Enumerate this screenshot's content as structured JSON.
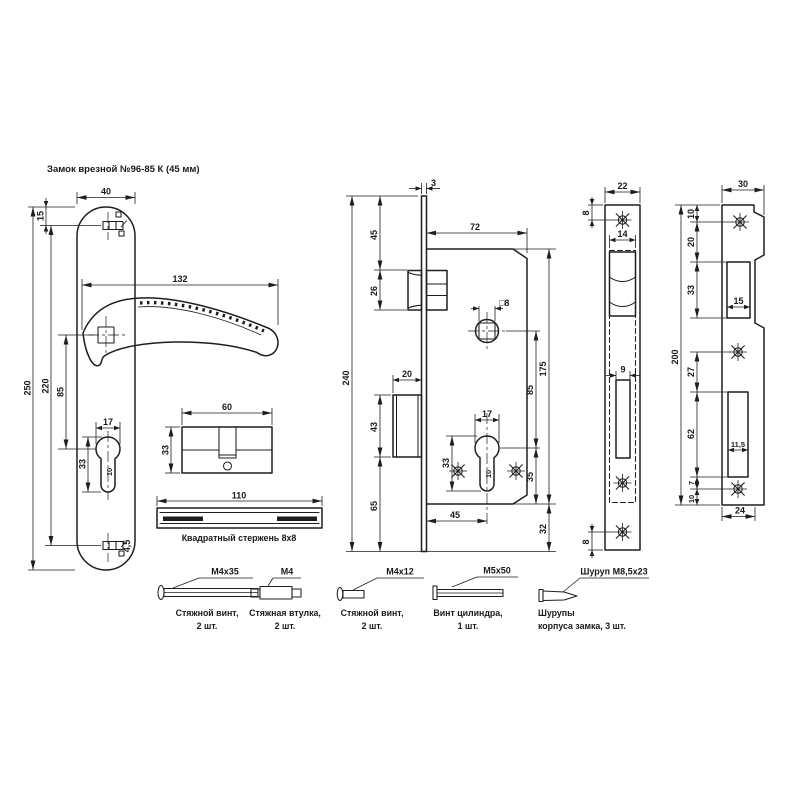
{
  "title": "Замок врезной №96-85 К (45 мм)",
  "colors": {
    "ink": "#1e1e1e",
    "background": "#ffffff"
  },
  "views": {
    "handle_plate": {
      "plate_width": "40",
      "top_edge_to_slot": "15",
      "plate_height": "250",
      "slot_span": "220",
      "handle_to_keyhole": "85",
      "handle_length": "132",
      "keyhole_width": "17",
      "keyhole_height": "33",
      "keyhole_slot_width": "10",
      "slot_hole": "4,5"
    },
    "cylinder": {
      "length": "60",
      "height": "33"
    },
    "square_rod": {
      "length": "110",
      "caption": "Квадратный стержень 8х8"
    },
    "lock_body": {
      "faceplate_thickness": "3",
      "faceplate_height": "240",
      "top_to_latch": "45",
      "latch_height": "26",
      "body_width": "72",
      "bolt_throw": "20",
      "bolt_height": "43",
      "bolt_to_bottom": "65",
      "body_height": "175",
      "spindle_to_keyhole": "85",
      "spindle_square": "□8",
      "keyhole_width": "17",
      "keyhole_height": "33",
      "keyhole_slot_width": "10",
      "keyhole_to_bottom": "35",
      "body_to_faceplate_end": "32",
      "backset": "45"
    },
    "faceplate": {
      "width": "22",
      "screw_to_top": "8",
      "inner_width": "14",
      "bolt_slot_width": "9",
      "screw_to_bottom": "8"
    },
    "strike_plate": {
      "width": "30",
      "height": "200",
      "top_to_screw": "10",
      "screw_to_latch": "20",
      "latch_opening_height": "33",
      "latch_opening_width": "15",
      "screw_to_bolt": "27",
      "bolt_opening_height": "62",
      "bolt_opening_width": "11,5",
      "bolt_to_screw": "7",
      "screw_to_bottom": "10",
      "flat_width": "24"
    }
  },
  "fasteners": [
    {
      "spec": "М4х35",
      "caption_lines": [
        "Стяжной винт,",
        "2 шт."
      ]
    },
    {
      "spec": "М4",
      "caption_lines": [
        "Стяжная втулка,",
        "2 шт."
      ]
    },
    {
      "spec": "М4х12",
      "caption_lines": [
        "Стяжной винт,",
        "2 шт."
      ]
    },
    {
      "spec": "М5х50",
      "caption_lines": [
        "Винт цилиндра,",
        "1 шт."
      ]
    },
    {
      "spec": "Шуруп М8,5х23",
      "caption_lines": [
        "Шурупы",
        "корпуса замка, 3 шт."
      ]
    }
  ]
}
